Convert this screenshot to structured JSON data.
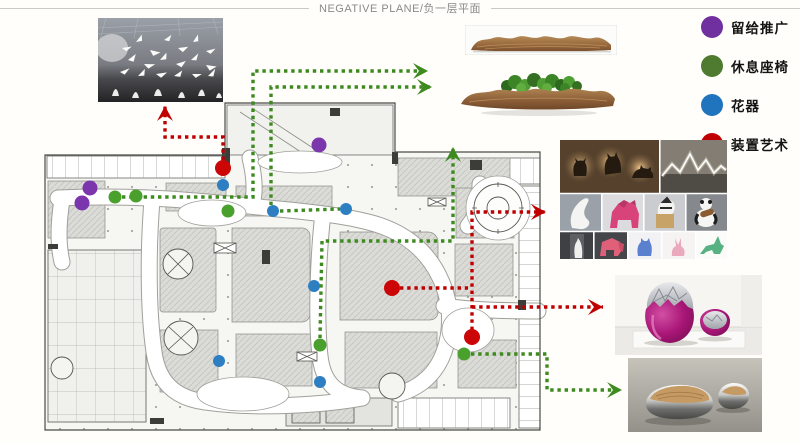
{
  "title": {
    "text": "NEGATIVE PLANE/负一层平面"
  },
  "legend": {
    "items": [
      {
        "id": "promo",
        "label": "留给推广",
        "color": "#7030a0"
      },
      {
        "id": "seating",
        "label": "休息座椅",
        "color": "#4e7b2f"
      },
      {
        "id": "planter",
        "label": "花器",
        "color": "#1f74bd"
      },
      {
        "id": "art",
        "label": "装置艺术",
        "color": "#c00000"
      }
    ]
  },
  "plan": {
    "marker_styles": {
      "promo": {
        "color": "#7b35ad",
        "r": 7.5
      },
      "seating": {
        "color": "#4aa02c",
        "r": 6.5
      },
      "planter": {
        "color": "#2e7fc2",
        "r": 6
      },
      "art": {
        "color": "#cc0606",
        "r": 8
      }
    },
    "line_colors": {
      "red": "#c00000",
      "green": "#3d8a1f"
    },
    "markers": [
      {
        "type": "promo",
        "x": 90,
        "y": 188
      },
      {
        "type": "promo",
        "x": 82,
        "y": 203
      },
      {
        "type": "promo",
        "x": 319,
        "y": 145
      },
      {
        "type": "seating",
        "x": 115,
        "y": 197
      },
      {
        "type": "seating",
        "x": 136,
        "y": 196
      },
      {
        "type": "seating",
        "x": 228,
        "y": 211
      },
      {
        "type": "seating",
        "x": 320,
        "y": 345
      },
      {
        "type": "seating",
        "x": 464,
        "y": 354
      },
      {
        "type": "planter",
        "x": 223,
        "y": 185
      },
      {
        "type": "planter",
        "x": 273,
        "y": 211
      },
      {
        "type": "planter",
        "x": 346,
        "y": 209
      },
      {
        "type": "planter",
        "x": 314,
        "y": 286
      },
      {
        "type": "planter",
        "x": 219,
        "y": 361
      },
      {
        "type": "planter",
        "x": 320,
        "y": 382
      },
      {
        "type": "art",
        "x": 223,
        "y": 168
      },
      {
        "type": "art",
        "x": 392,
        "y": 288
      },
      {
        "type": "art",
        "x": 472,
        "y": 337
      }
    ],
    "arrows": [
      {
        "color": "red",
        "head": true,
        "points": [
          [
            223,
            160
          ],
          [
            223,
            137
          ],
          [
            165,
            137
          ],
          [
            165,
            106
          ]
        ]
      },
      {
        "color": "red",
        "head": false,
        "points": [
          [
            400,
            288
          ],
          [
            468,
            288
          ]
        ]
      },
      {
        "color": "red",
        "head": true,
        "points": [
          [
            472,
            330
          ],
          [
            472,
            212
          ],
          [
            546,
            212
          ]
        ]
      },
      {
        "color": "red",
        "head": true,
        "points": [
          [
            472,
            307
          ],
          [
            603,
            307
          ]
        ]
      },
      {
        "color": "green",
        "head": true,
        "points": [
          [
            122,
            197
          ],
          [
            253,
            197
          ],
          [
            253,
            71
          ],
          [
            428,
            71
          ]
        ]
      },
      {
        "color": "green",
        "head": true,
        "points": [
          [
            271,
            205
          ],
          [
            271,
            87
          ],
          [
            432,
            87
          ]
        ]
      },
      {
        "color": "green",
        "head": false,
        "points": [
          [
            280,
            211
          ],
          [
            340,
            209
          ]
        ]
      },
      {
        "color": "green",
        "head": true,
        "points": [
          [
            320,
            338
          ],
          [
            322,
            241
          ],
          [
            453,
            241
          ],
          [
            453,
            147
          ]
        ]
      },
      {
        "color": "green",
        "head": true,
        "points": [
          [
            471,
            354
          ],
          [
            547,
            354
          ],
          [
            547,
            390
          ],
          [
            622,
            390
          ]
        ]
      }
    ]
  }
}
